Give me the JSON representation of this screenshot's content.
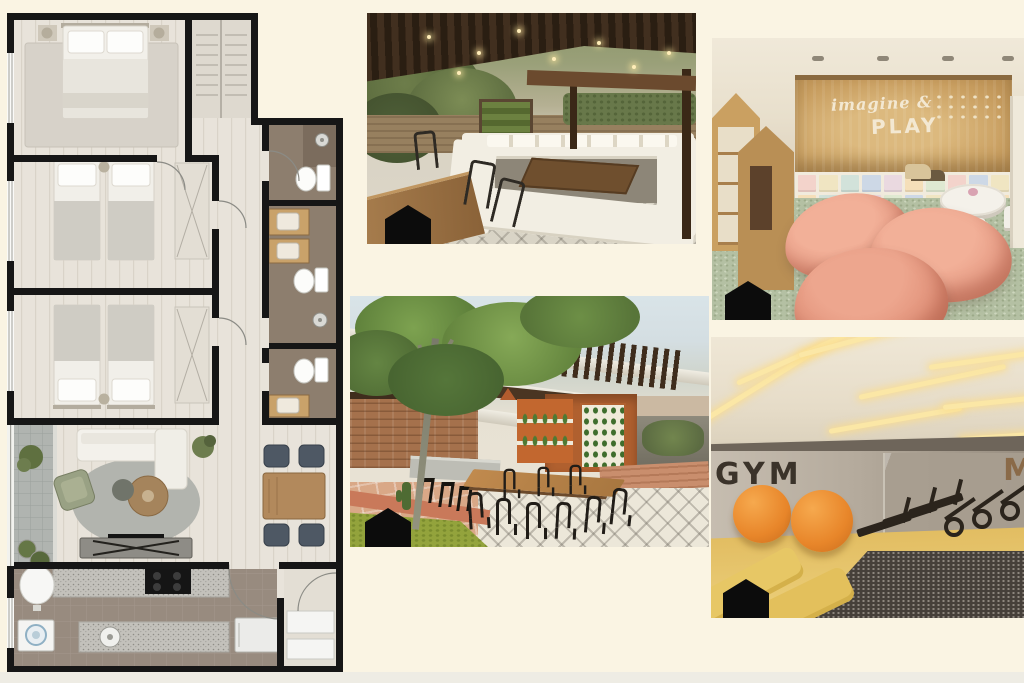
{
  "page": {
    "background_color": "#faf4e3",
    "bottom_strip_color": "#eeece4",
    "description": "Property listing collage: apartment floor plan and four amenity renders"
  },
  "floor_plan": {
    "label": "apartment floor plan",
    "wall_color": "#161616",
    "rooms": [
      "master-bedroom",
      "closet",
      "bathroom-1",
      "bedroom-2",
      "bathroom-2",
      "bedroom-3",
      "bathroom-3",
      "hallway",
      "balcony",
      "living-room",
      "dining-area",
      "kitchen",
      "entry"
    ]
  },
  "photos": {
    "terrace": {
      "name": "rooftop-terrace-lounge-render"
    },
    "playroom": {
      "name": "kids-playroom-render",
      "sign_line1": "imagine &",
      "sign_line2": "PLAY",
      "sign_color": "#f3e8d2",
      "pouf_color": "#e69b84",
      "carpet_color": "#b4c0a3",
      "cubby_colors": [
        "#f3d3cb",
        "#f0e5c2",
        "#d2e2da",
        "#cdd8e6",
        "#ead9e0",
        "#f5dfb9",
        "#dfe9d1",
        "#f3d3cb",
        "#cdd8e6",
        "#f0e5c2",
        "#f5dfb9",
        "#d2e2da",
        "#f3d3cb",
        "#ead9e0",
        "#dfe9d1",
        "#cdd8e6",
        "#f0e5c2",
        "#f3d3cb",
        "#d2e2da",
        "#f5dfb9"
      ]
    },
    "patio": {
      "name": "courtyard-dining-patio-render"
    },
    "gym": {
      "name": "fitness-gym-render",
      "sign": "GYM",
      "sign_color": "#3b332a",
      "right_partial_sign": "M",
      "ball_color": "#e8862a",
      "floor_color": "#e2bd62"
    }
  },
  "watermark": {
    "shape": "house-silhouette",
    "color": "#0c0c0c"
  }
}
